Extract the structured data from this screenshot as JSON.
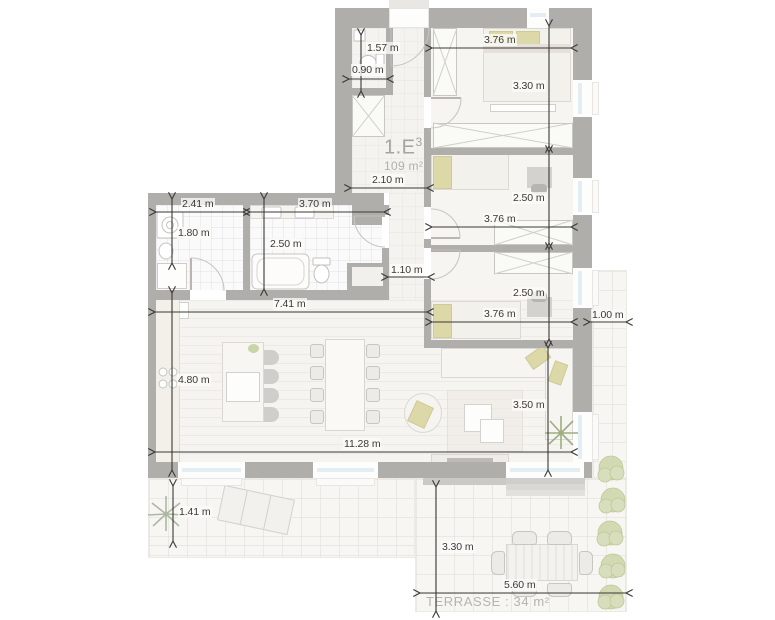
{
  "unit": {
    "name": "1.E",
    "superscript": "3",
    "area": "109 m²"
  },
  "terrace": {
    "label": "TERRASSE : 34 m²"
  },
  "colors": {
    "wall": "#b0aeab",
    "dimension": "#3a3936",
    "pillow_accent": "#dcd8a8",
    "plant_green": "#c5d0a2",
    "window_glass": "#e2edf4",
    "floor": "#f6f4f0",
    "unit_label_gray": "#a6a4a1"
  },
  "dimensions": [
    {
      "label": "1.57 m",
      "orient": "v",
      "x": 361,
      "y": 35,
      "len": 56,
      "lx": 366,
      "ly": 42
    },
    {
      "label": "0.90 m",
      "orient": "h",
      "x": 349,
      "y": 79,
      "len": 38,
      "lx": 351,
      "ly": 64
    },
    {
      "label": "3.76 m",
      "orient": "h",
      "x": 432,
      "y": 48,
      "len": 139,
      "lx": 483,
      "ly": 34
    },
    {
      "label": "3.30 m",
      "orient": "v",
      "x": 549,
      "y": 26,
      "len": 120,
      "lx": 512,
      "ly": 80
    },
    {
      "label": "2.10 m",
      "orient": "h",
      "x": 351,
      "y": 188,
      "len": 76,
      "lx": 371,
      "ly": 174
    },
    {
      "label": "2.50 m",
      "orient": "v",
      "x": 549,
      "y": 152,
      "len": 91,
      "lx": 512,
      "ly": 192
    },
    {
      "label": "3.76 m",
      "orient": "h",
      "x": 432,
      "y": 227,
      "len": 139,
      "lx": 483,
      "ly": 213
    },
    {
      "label": "2.50 m",
      "orient": "v",
      "x": 549,
      "y": 249,
      "len": 90,
      "lx": 512,
      "ly": 287
    },
    {
      "label": "3.76 m",
      "orient": "h",
      "x": 432,
      "y": 322,
      "len": 139,
      "lx": 483,
      "ly": 308
    },
    {
      "label": "1.00 m",
      "orient": "h",
      "x": 590,
      "y": 322,
      "len": 36,
      "lx": 591,
      "ly": 309
    },
    {
      "label": "2.41 m",
      "orient": "h",
      "x": 156,
      "y": 212,
      "len": 87,
      "lx": 181,
      "ly": 198
    },
    {
      "label": "1.80 m",
      "orient": "v",
      "x": 172,
      "y": 199,
      "len": 64,
      "lx": 177,
      "ly": 227
    },
    {
      "label": "3.70 m",
      "orient": "h",
      "x": 250,
      "y": 212,
      "len": 134,
      "lx": 298,
      "ly": 198
    },
    {
      "label": "2.50 m",
      "orient": "v",
      "x": 264,
      "y": 199,
      "len": 90,
      "lx": 269,
      "ly": 238
    },
    {
      "label": "1.10 m",
      "orient": "h",
      "x": 388,
      "y": 277,
      "len": 40,
      "lx": 390,
      "ly": 264
    },
    {
      "label": "7.41 m",
      "orient": "h",
      "x": 155,
      "y": 312,
      "len": 272,
      "lx": 273,
      "ly": 298
    },
    {
      "label": "4.80 m",
      "orient": "v",
      "x": 172,
      "y": 293,
      "len": 177,
      "lx": 177,
      "ly": 374
    },
    {
      "label": "11.28 m",
      "orient": "h",
      "x": 155,
      "y": 452,
      "len": 416,
      "lx": 343,
      "ly": 438
    },
    {
      "label": "3.50 m",
      "orient": "v",
      "x": 548,
      "y": 348,
      "len": 122,
      "lx": 512,
      "ly": 399
    },
    {
      "label": "1.41 m",
      "orient": "v",
      "x": 173,
      "y": 486,
      "len": 55,
      "lx": 178,
      "ly": 506
    },
    {
      "label": "3.30 m",
      "orient": "v",
      "x": 436,
      "y": 487,
      "len": 124,
      "lx": 441,
      "ly": 541
    },
    {
      "label": "5.60 m",
      "orient": "h",
      "x": 420,
      "y": 593,
      "len": 206,
      "lx": 503,
      "ly": 579
    }
  ]
}
